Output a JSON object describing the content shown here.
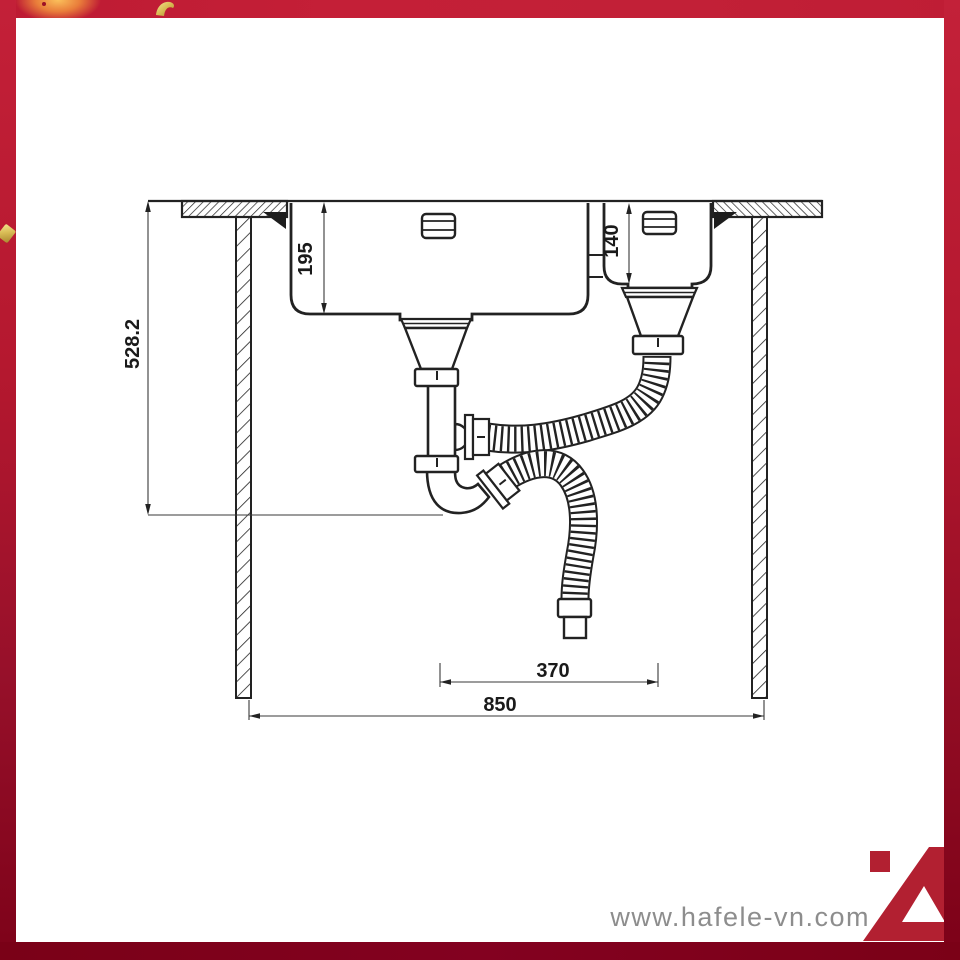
{
  "drawing": {
    "title": "sink-installation-side-section",
    "dimensions": {
      "total_height": "528.2",
      "main_bowl_depth": "195",
      "small_bowl_depth": "140",
      "drain_spacing": "370",
      "total_width": "850"
    }
  },
  "watermark": {
    "url_text": "www.hafele-vn.com"
  },
  "branding": {
    "logo": "hafele-a-logo",
    "logo_color": "#b22031"
  },
  "colors": {
    "frame_top": "#c21f36",
    "frame_bottom": "#7b0118",
    "line": "#222222",
    "dimension_text": "#1a1a1a",
    "watermark_gray": "#8d8d8d",
    "confetti_gold": "#d9bc55"
  }
}
